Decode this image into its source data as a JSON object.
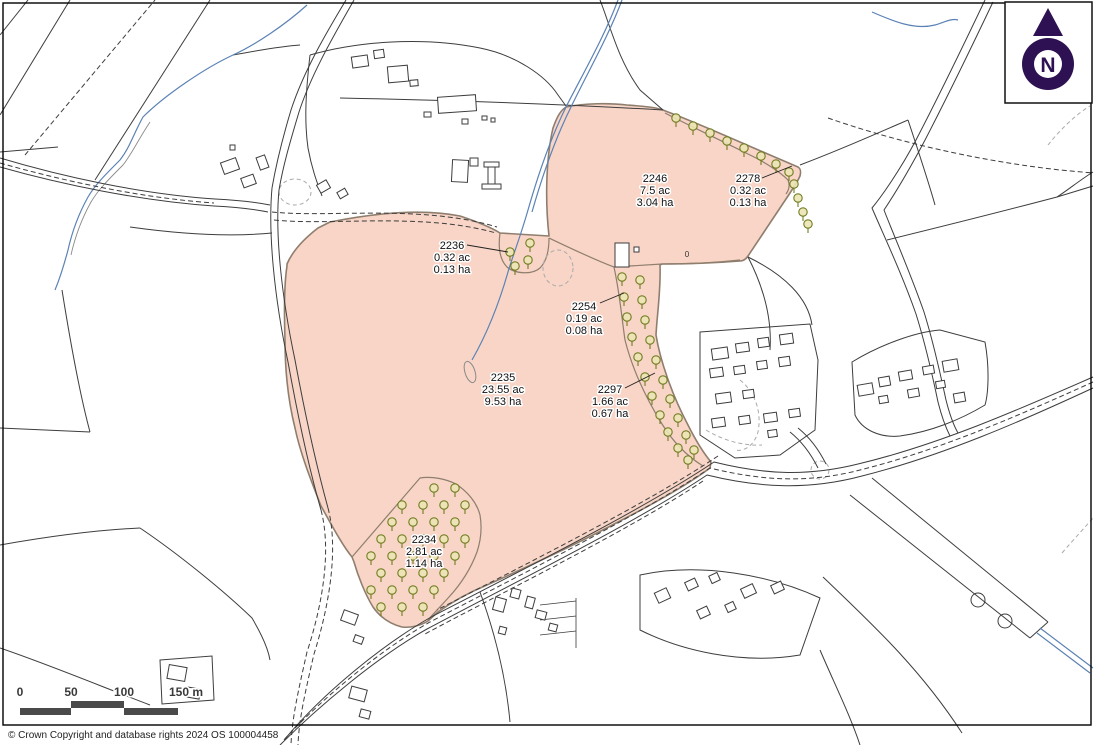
{
  "map": {
    "parcels": [
      {
        "id": "2246",
        "area_ac": "7.5 ac",
        "area_ha": "3.04 ha"
      },
      {
        "id": "2278",
        "area_ac": "0.32 ac",
        "area_ha": "0.13 ha"
      },
      {
        "id": "2236",
        "area_ac": "0.32 ac",
        "area_ha": "0.13 ha"
      },
      {
        "id": "2254",
        "area_ac": "0.19 ac",
        "area_ha": "0.08 ha"
      },
      {
        "id": "2235",
        "area_ac": "23.55 ac",
        "area_ha": "9.53 ha"
      },
      {
        "id": "2297",
        "area_ac": "1.66 ac",
        "area_ha": "0.67 ha"
      },
      {
        "id": "2234",
        "area_ac": "2.81 ac",
        "area_ha": "1.14 ha"
      }
    ],
    "north_indicator": {
      "letter": "N"
    },
    "scale_bar": {
      "ticks": [
        "0",
        "50",
        "100",
        "150 m"
      ]
    },
    "misc_marker": "0",
    "copyright": "© Crown Copyright and database rights 2024 OS 100004458",
    "colors": {
      "parcel_fill": "#f8d5c6",
      "parcel_outline": "#8f7e6e",
      "tree": "#6f7d20",
      "stream": "#5b82b5",
      "line": "#3d3d3d",
      "north": "#2e1152",
      "scale_bar": "#4a4a4a"
    }
  }
}
